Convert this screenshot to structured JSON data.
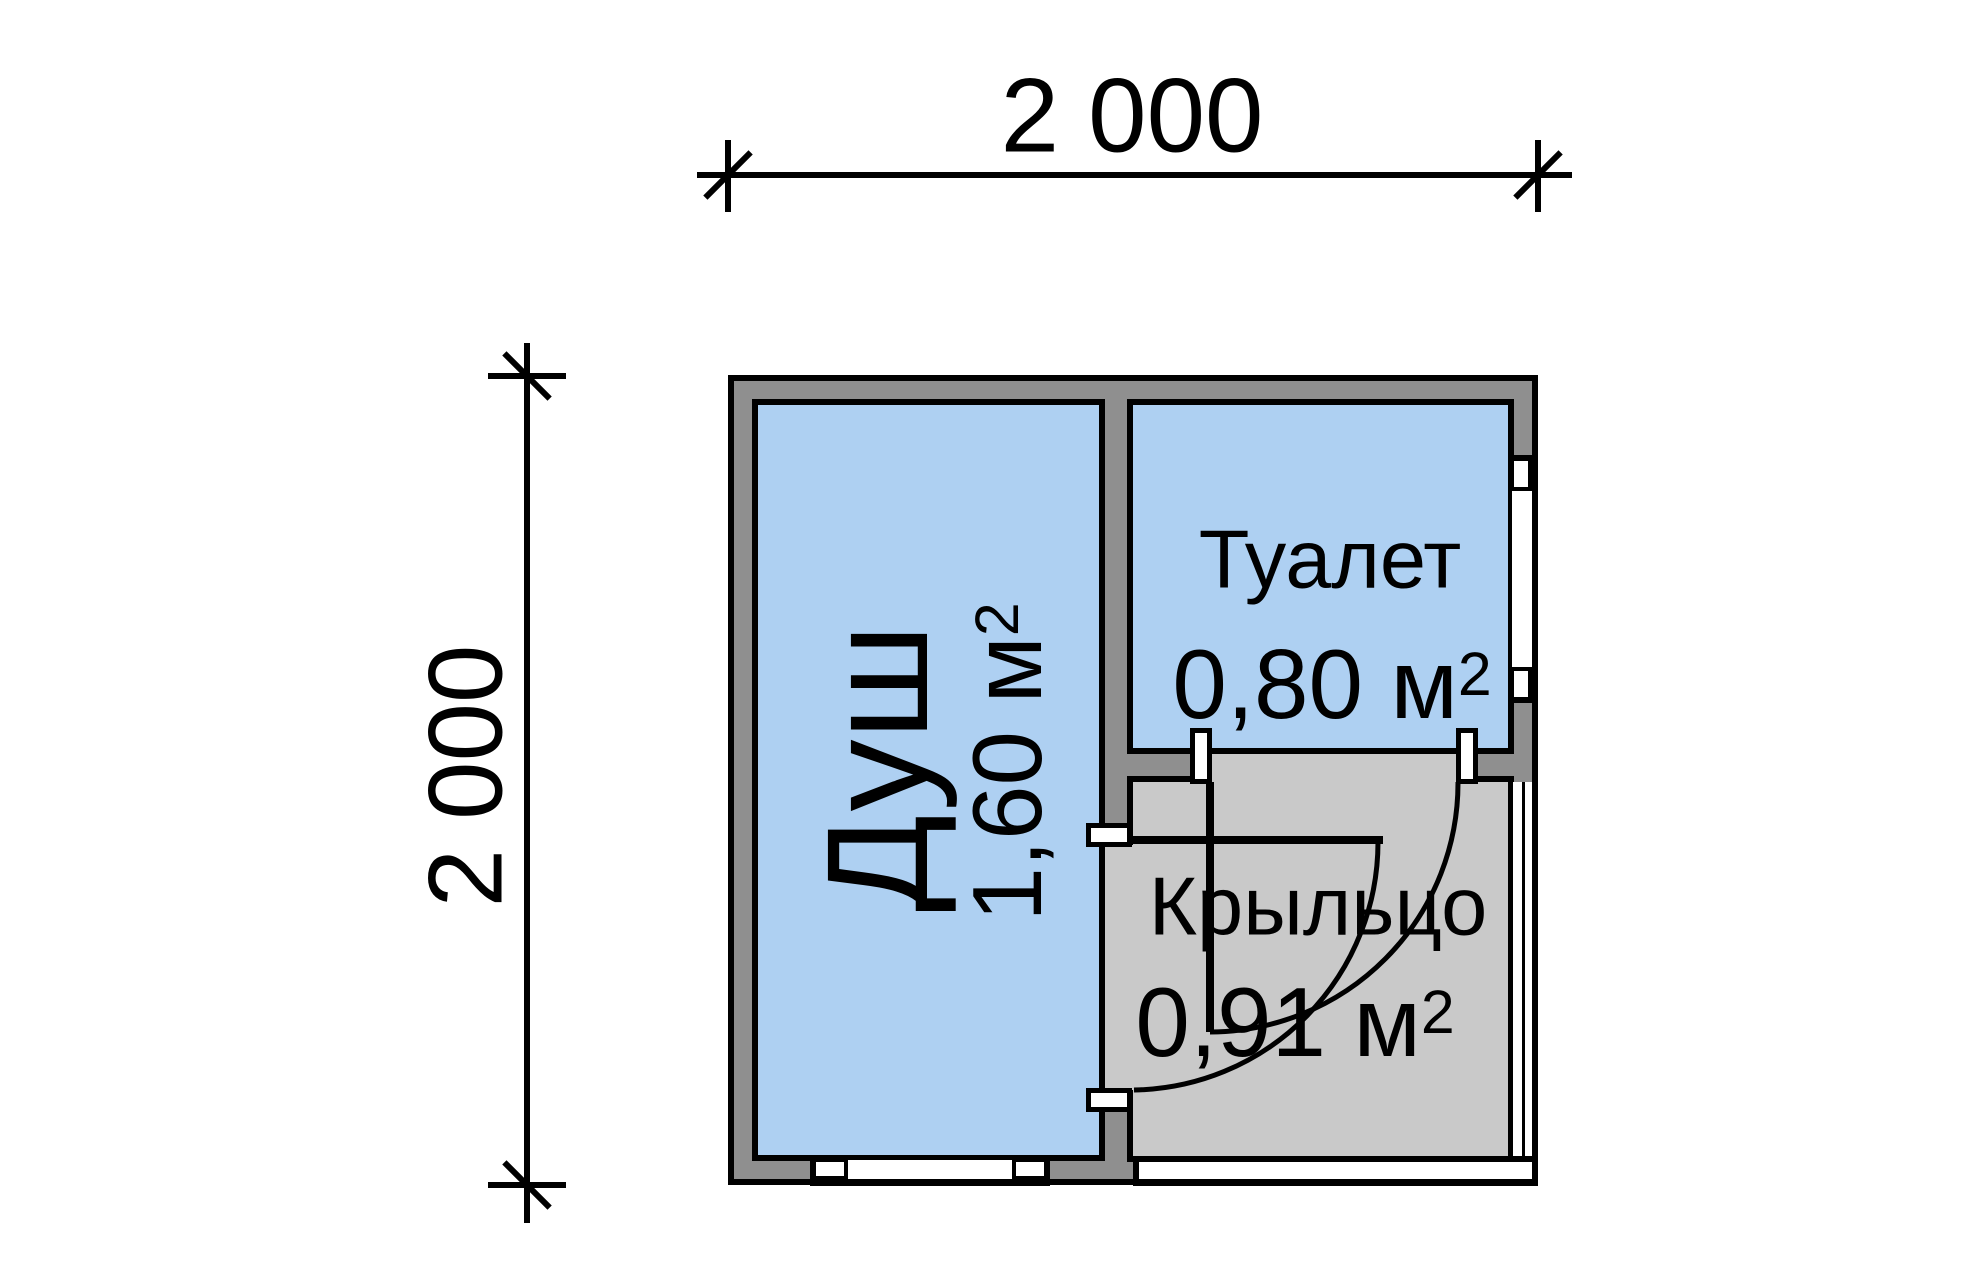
{
  "plan": {
    "title": "floor plan 2000x2000 shower-toilet cabin",
    "dim_top": "2 000",
    "dim_left": "2 000",
    "rooms": [
      {
        "id": "shower",
        "name": "Душ",
        "area": "1,60",
        "unit": "м",
        "sup": "2"
      },
      {
        "id": "toilet",
        "name": "Туалет",
        "area": "0,80",
        "unit": "м",
        "sup": "2"
      },
      {
        "id": "porch",
        "name": "Крыльцо",
        "area": "0,91",
        "unit": "м",
        "sup": "2"
      }
    ],
    "colors": {
      "bg": "#ffffff",
      "room": "#aed0f2",
      "wall": "#8f8f8f",
      "porch": "#c9c9c9",
      "line": "#000000"
    }
  }
}
